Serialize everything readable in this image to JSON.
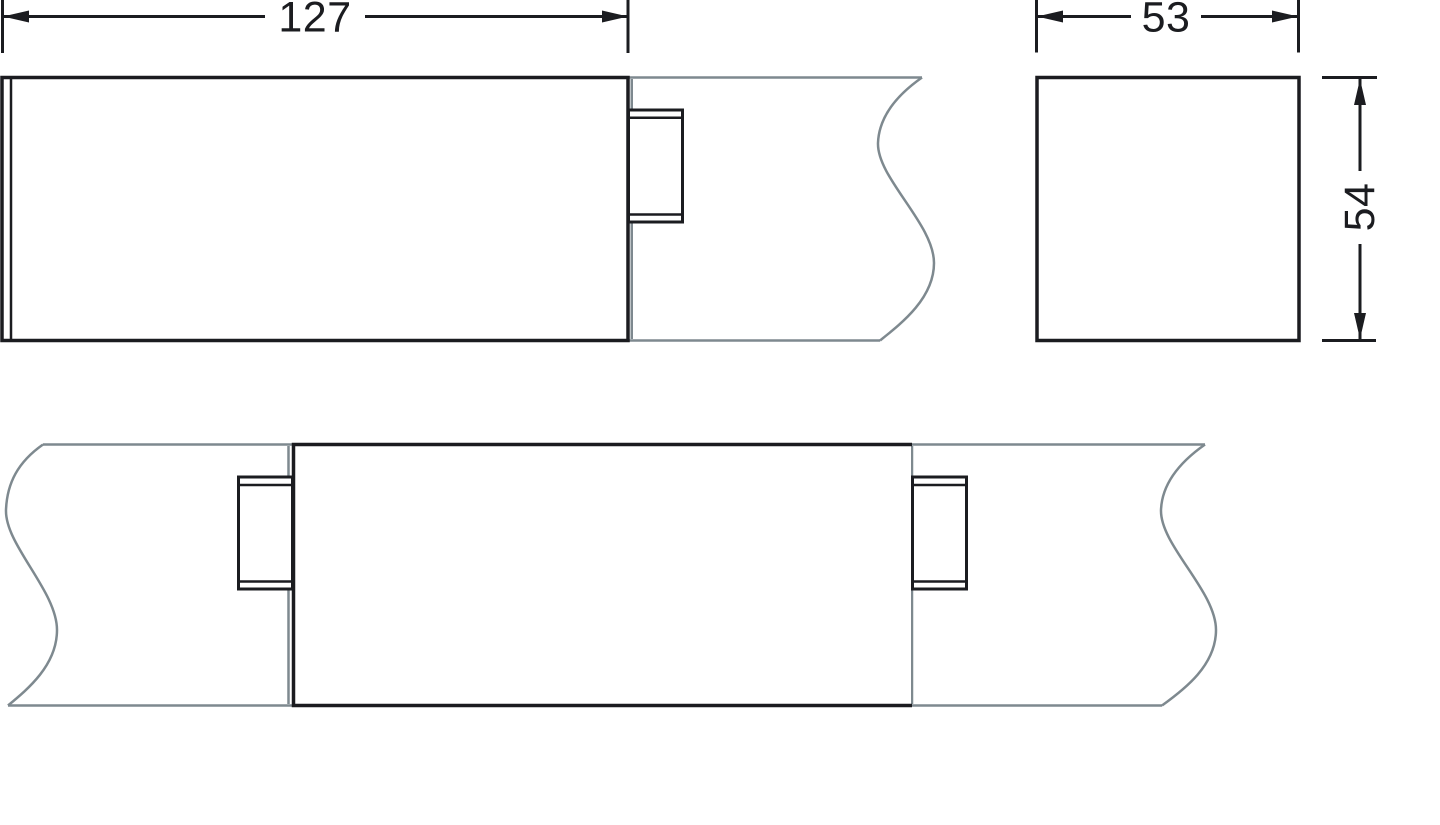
{
  "title": "Technical dimension drawing — cable trunking joint cover",
  "canvas": {
    "width": 1440,
    "height": 825,
    "background": "#ffffff"
  },
  "colors": {
    "line": "#1b1c20",
    "break_line": "#7e898f",
    "fill": "#ffffff"
  },
  "views": {
    "side_view": {
      "description": "cover end view on channel with break line",
      "dim_length": {
        "value": "127"
      }
    },
    "cross_section": {
      "description": "square cross section",
      "dim_width": {
        "value": "53"
      },
      "dim_height": {
        "value": "54"
      }
    },
    "joint_view": {
      "description": "joint cover bridging two channels with clips"
    }
  }
}
